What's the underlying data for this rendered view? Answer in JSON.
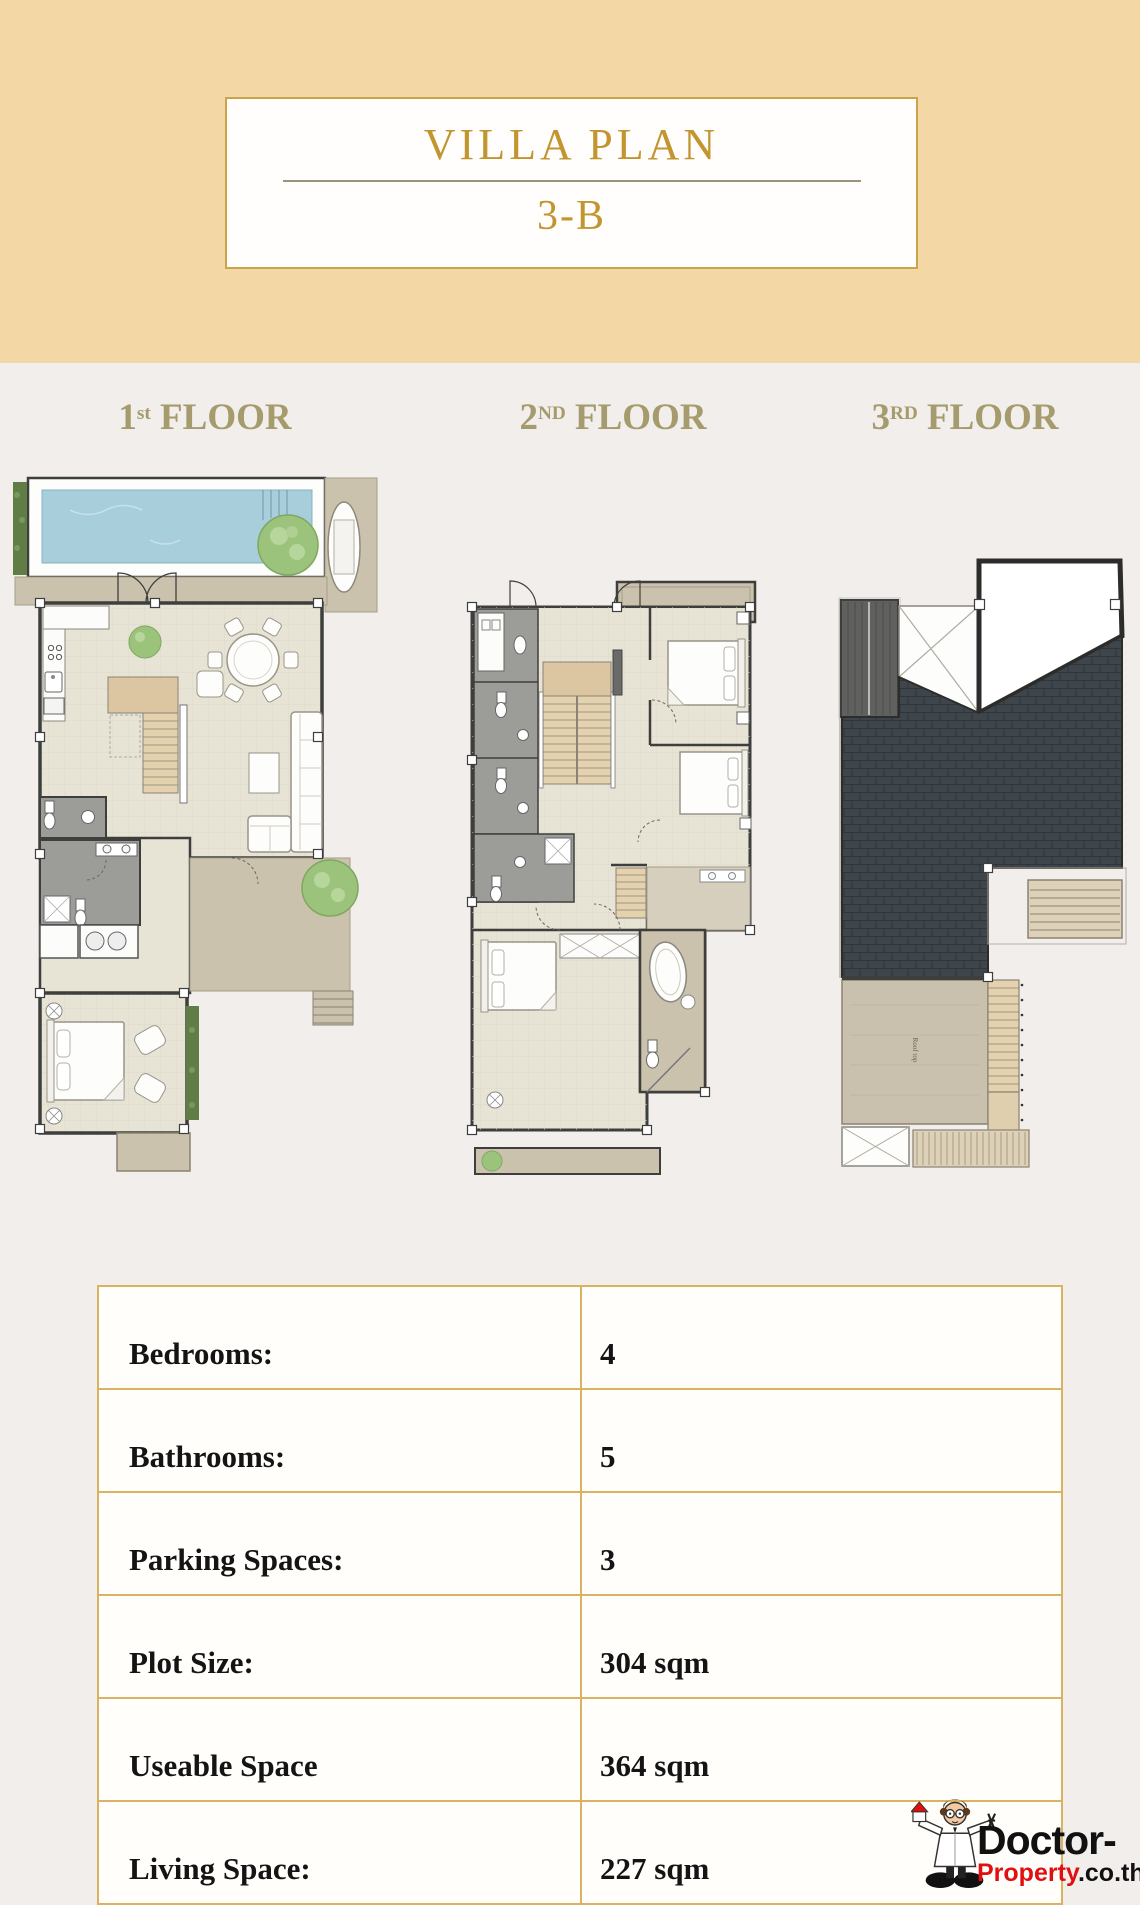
{
  "header": {
    "title": "VILLA PLAN",
    "code": "3-B"
  },
  "floors": [
    {
      "num": "1",
      "sup": "st",
      "word": " FLOOR"
    },
    {
      "num": "2",
      "sup": "ND",
      "word": " FLOOR"
    },
    {
      "num": "3",
      "sup": "RD",
      "word": " FLOOR"
    }
  ],
  "plans": {
    "rooftop_label": "Roof top"
  },
  "specs": {
    "rows": [
      {
        "label": "Bedrooms:",
        "value": "4"
      },
      {
        "label": "Bathrooms:",
        "value": "5"
      },
      {
        "label": "Parking Spaces:",
        "value": "3"
      },
      {
        "label": "Plot Size:",
        "value": "304 sqm"
      },
      {
        "label": "Useable Space",
        "value": "364  sqm"
      },
      {
        "label": "Living Space:",
        "value": "227 sqm"
      }
    ]
  },
  "watermark": {
    "line1": "Doctor-",
    "line2_red": "Property",
    "line2_black": ".co.th"
  },
  "colors": {
    "header_bg": "#f3d8a5",
    "body_bg": "#f1eeeb",
    "accent_gold": "#c9a44b",
    "title_gold": "#c2952f",
    "floor_label": "#a59b6d",
    "table_border": "#d9b262",
    "pool_water": "#a9cedb",
    "roof_dark": "#3f464b",
    "tree_green": "#9cc37b",
    "bath_gray": "#9c9c98",
    "deck_taupe": "#cbc2ad",
    "logo_red": "#e01010"
  }
}
